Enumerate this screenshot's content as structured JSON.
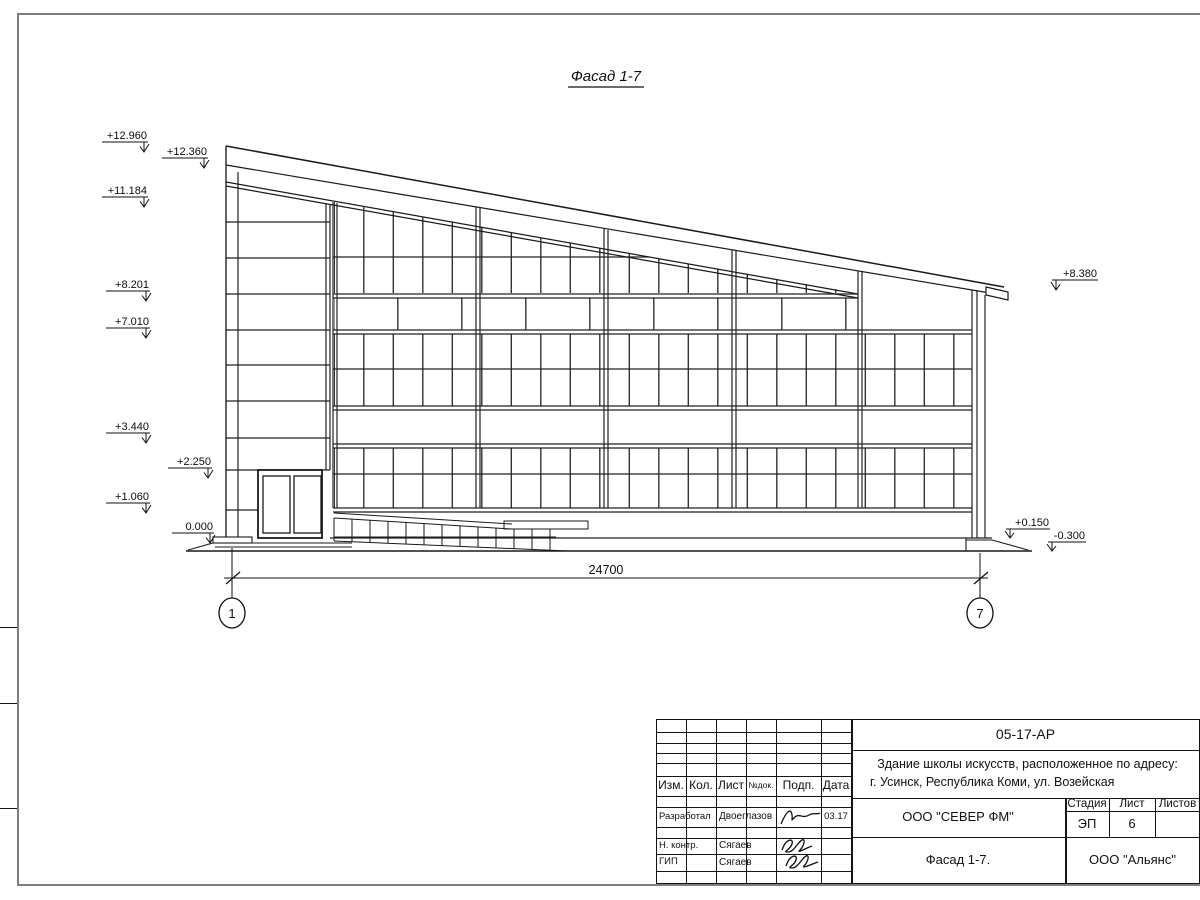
{
  "sheet": {
    "drawing_title": "Фасад 1-7",
    "dimension_label": "24700",
    "axis_left": "1",
    "axis_right": "7",
    "elevations_left": [
      "+12.960",
      "+12.360",
      "+11.184",
      "+8.201",
      "+7.010",
      "+3.440",
      "+2.250",
      "+1.060",
      "0.000"
    ],
    "elevations_right": [
      "+8.380",
      "+0.150",
      "-0.300"
    ]
  },
  "title_block": {
    "doc_number": "05-17-АР",
    "project_desc_line1": "Здание школы искусств, расположенное по адресу:",
    "project_desc_line2": "г. Усинск, Республика Коми, ул. Возейская",
    "columns": {
      "izm": "Изм.",
      "kol": "Кол.",
      "list": "Лист",
      "ndok": "№док.",
      "podp": "Подп.",
      "data": "Дата"
    },
    "rows": [
      {
        "role": "Разработал",
        "name": "Двоеглазов",
        "date": "03.17"
      },
      {
        "role": "Н. контр.",
        "name": "Сягаев",
        "date": ""
      },
      {
        "role": "ГИП",
        "name": "Сягаев",
        "date": ""
      }
    ],
    "company": "ООО \"СЕВЕР ФМ\"",
    "sheet_title": "Фасад 1-7.",
    "contractor": "ООО \"Альянс\"",
    "stage_label": "Стадия",
    "stage": "ЭП",
    "sheet_label": "Лист",
    "sheet_no": "6",
    "sheets_label": "Листов",
    "sheets_total": ""
  }
}
